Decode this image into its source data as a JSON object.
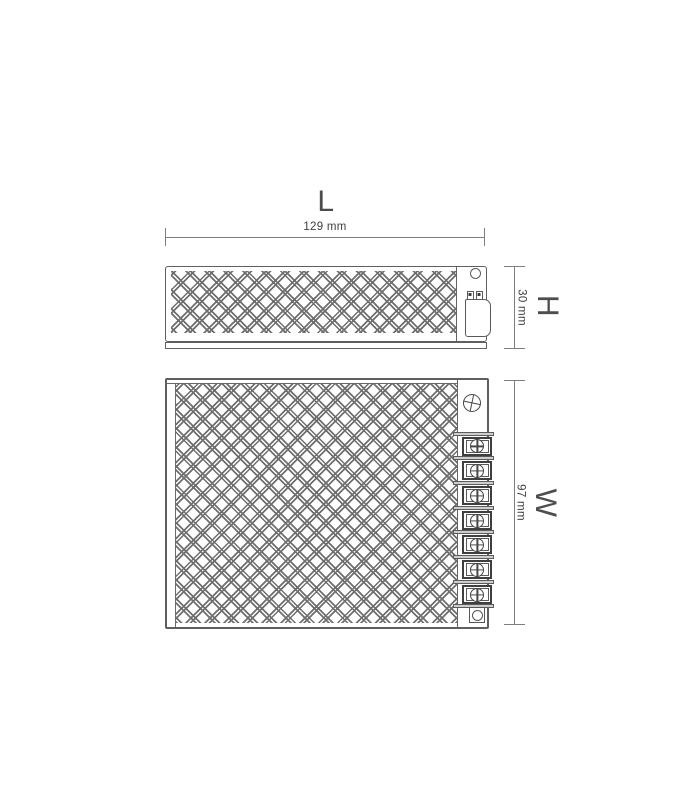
{
  "colors": {
    "background": "#ffffff",
    "outline": "#5f5f5f",
    "mesh": "#6f6f6f",
    "dimension_line": "#7e7e7e",
    "text": "#3e3e3e"
  },
  "dimensions": {
    "length": {
      "label": "L",
      "value": "129 mm"
    },
    "height": {
      "label": "H",
      "value": "30 mm"
    },
    "width": {
      "label": "W",
      "value": "97 mm"
    }
  },
  "side_view": {
    "connector_pins": 2,
    "mounting_holes": 1
  },
  "front_view": {
    "terminal_blocks": 7,
    "panel_screws": 1,
    "corner_holes": 1
  }
}
